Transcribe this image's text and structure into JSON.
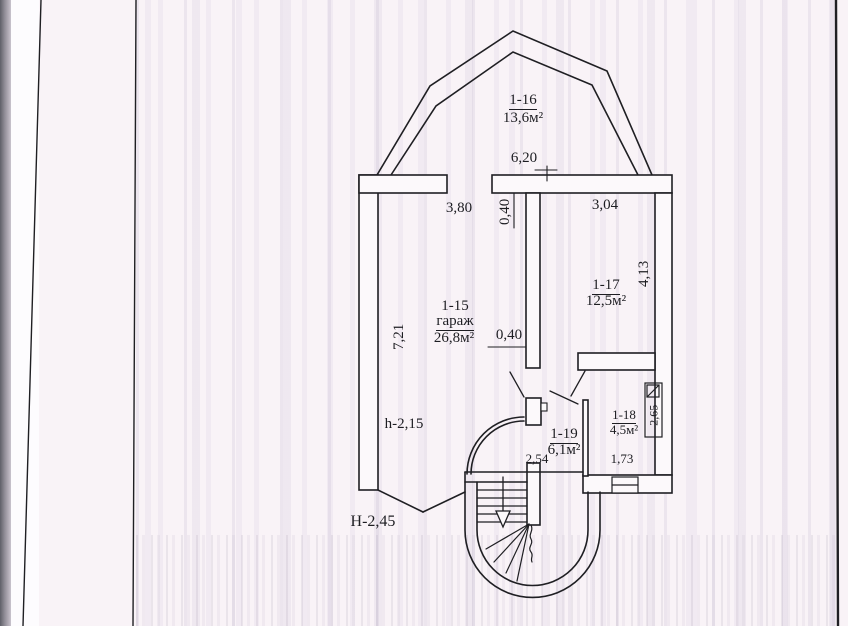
{
  "plan": {
    "rooms": [
      {
        "id": "1-16",
        "area": "13,6м²"
      },
      {
        "id": "1-15",
        "name": "гараж",
        "area": "26,8м²"
      },
      {
        "id": "1-17",
        "area": "12,5м²"
      },
      {
        "id": "1-18",
        "area": "4,5м²"
      },
      {
        "id": "1-19",
        "area": "6,1м²"
      }
    ],
    "dimensions": {
      "top_width": "6,20",
      "garage_top_width": "3,80",
      "partition_thickness_top": "0,40",
      "room_1_17_width": "3,04",
      "room_1_17_depth": "4,13",
      "garage_depth": "7,21",
      "partition_thickness_mid": "0,40",
      "stair_width": "2,54",
      "room_1_18_width": "1,73",
      "room_1_18_depth": "2,65"
    },
    "heights": {
      "ceiling_low": "h-2,15",
      "ceiling_main": "H-2,45"
    },
    "colors": {
      "ink": "#1f1f23",
      "paper": "#f9f3f7"
    }
  }
}
